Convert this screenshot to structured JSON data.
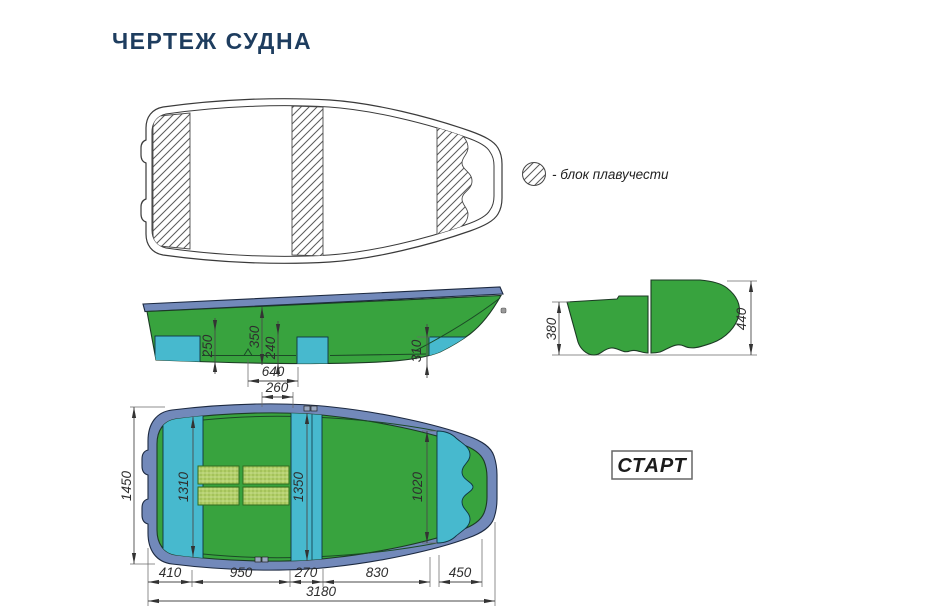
{
  "page": {
    "title": "ЧЕРТЕЖ СУДНА"
  },
  "legend": {
    "label": "- блок плавучести"
  },
  "model": {
    "name": "СТАРТ"
  },
  "colors": {
    "hull_green": "#38a33e",
    "buoyancy_cyan": "#47b9ce",
    "gunwale_blue": "#7289ba",
    "grating_green": "#b2cf67",
    "title_navy": "#1e3d5f"
  },
  "dims": {
    "side": {
      "stern_block_height": "250",
      "depth_amidships": "350",
      "mid_block_height": "240",
      "bow_block_height": "310",
      "floor_between_blocks": "640"
    },
    "section": {
      "transom_height": "380",
      "midship_height": "440"
    },
    "plan": {
      "oarlock_offset": "260",
      "overall_beam": "1450",
      "stern_block_width": "1310",
      "mid_block_width": "1350",
      "bow_block_width": "1020",
      "stern_segment": "410",
      "cockpit_segment": "950",
      "mid_seat_segment": "270",
      "bow_segment": "830",
      "bow_block_segment": "450",
      "overall_length": "3180"
    }
  }
}
